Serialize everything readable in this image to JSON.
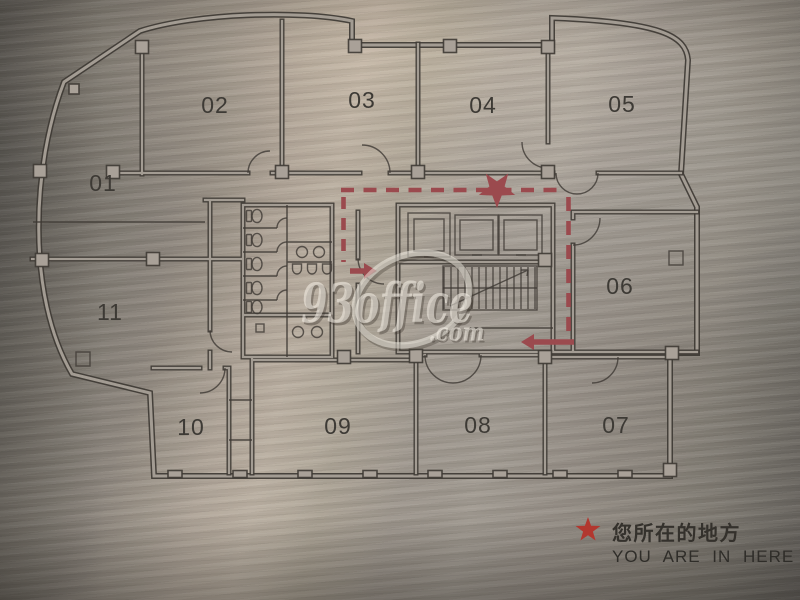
{
  "plan": {
    "rooms": [
      {
        "id": "01",
        "label": "01"
      },
      {
        "id": "02",
        "label": "02"
      },
      {
        "id": "03",
        "label": "03"
      },
      {
        "id": "04",
        "label": "04"
      },
      {
        "id": "05",
        "label": "05"
      },
      {
        "id": "06",
        "label": "06"
      },
      {
        "id": "07",
        "label": "07"
      },
      {
        "id": "08",
        "label": "08"
      },
      {
        "id": "09",
        "label": "09"
      },
      {
        "id": "10",
        "label": "10"
      },
      {
        "id": "11",
        "label": "11"
      }
    ]
  },
  "watermark": {
    "name": "93office",
    "tld": ".com"
  },
  "legend": {
    "zh": "您所在的地方",
    "en": "YOU ARE IN HERE"
  },
  "colors": {
    "route_red": "#9b4a4e",
    "legend_star_red": "#b2372f",
    "plan_ink": "#3e3a34",
    "metal_light": "#b2a698",
    "metal_dark": "#5d5a55"
  }
}
